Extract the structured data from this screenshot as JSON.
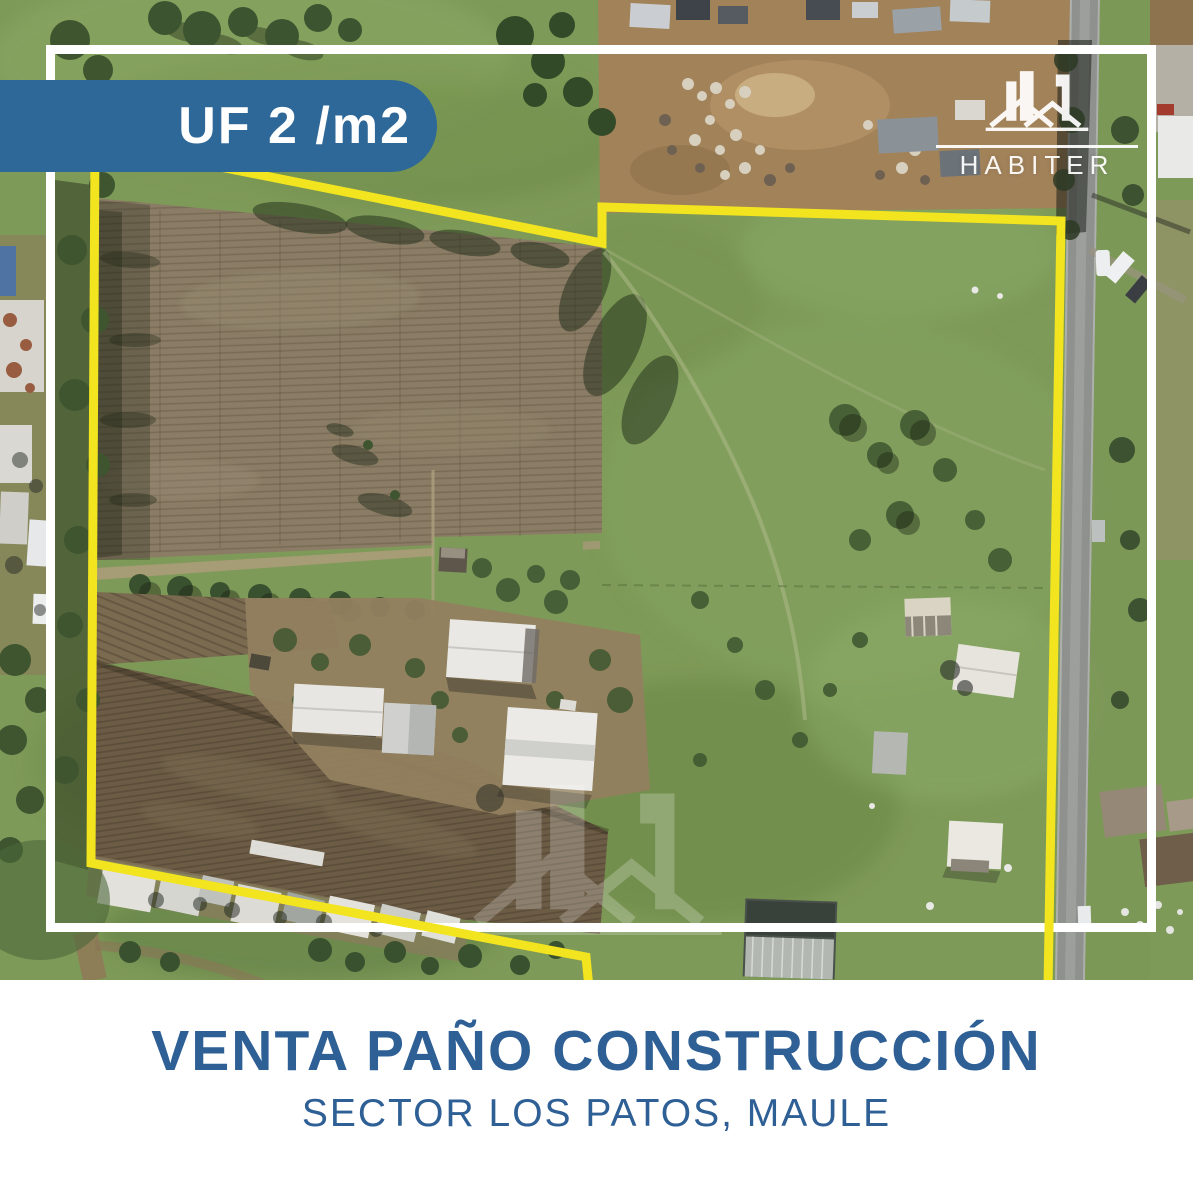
{
  "badge": {
    "label": "UF 2 /m2"
  },
  "brand": {
    "name": "HABITER"
  },
  "caption": {
    "title": "VENTA PAÑO CONSTRUCCIÓN",
    "subtitle": "SECTOR LOS PATOS, MAULE"
  },
  "colors": {
    "badge_bg": "#2e6898",
    "badge_text": "#ffffff",
    "title_text": "#2e5f95",
    "boundary_yellow": "#f2e41f",
    "frame_white": "#ffffff",
    "watermark_white": "#ffffff"
  }
}
